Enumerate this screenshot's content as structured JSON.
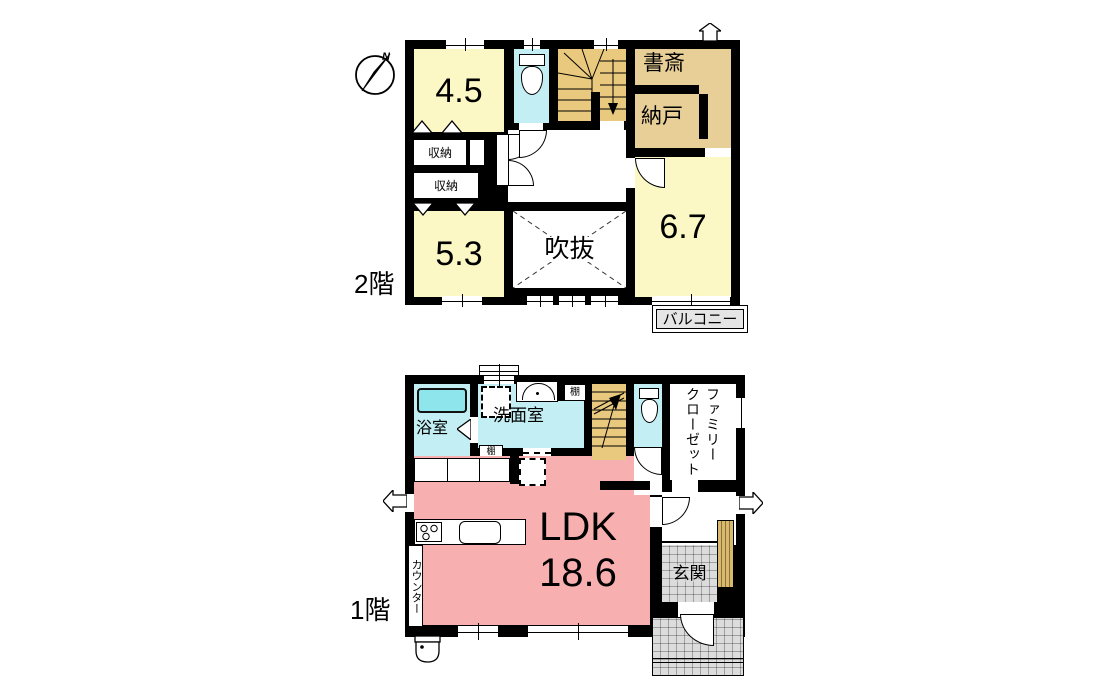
{
  "colors": {
    "wall": "#000000",
    "room_yellow": "#FBF8C5",
    "room_tan": "#E7CF97",
    "stair_tan": "#E9C97E",
    "water_cyan": "#C3EEF3",
    "tub_cyan": "#8FE5EC",
    "ldk_pink": "#F8AFAF",
    "tile_gray": "#DCDCDC",
    "balcony_gray": "#E5E5E5",
    "shoe_tan": "#D9B96B"
  },
  "floor2": {
    "floor_label": "2階",
    "compass_north": "N",
    "room_45": "4.5",
    "room_53": "5.3",
    "room_67": "6.7",
    "study": "書斎",
    "storeroom": "納戸",
    "closet_upper": "収納",
    "closet_lower": "収納",
    "void": "吹抜",
    "balcony": "バルコニー"
  },
  "floor1": {
    "floor_label": "1階",
    "bathroom": "浴室",
    "washroom": "洗面室",
    "shelf_top": "棚",
    "shelf_bottom": "棚",
    "family_closet_line1": "ファミリー",
    "family_closet_line2": "クローゼット",
    "ldk": "LDK",
    "ldk_size": "18.6",
    "counter": "カウンター",
    "entrance": "玄関"
  }
}
